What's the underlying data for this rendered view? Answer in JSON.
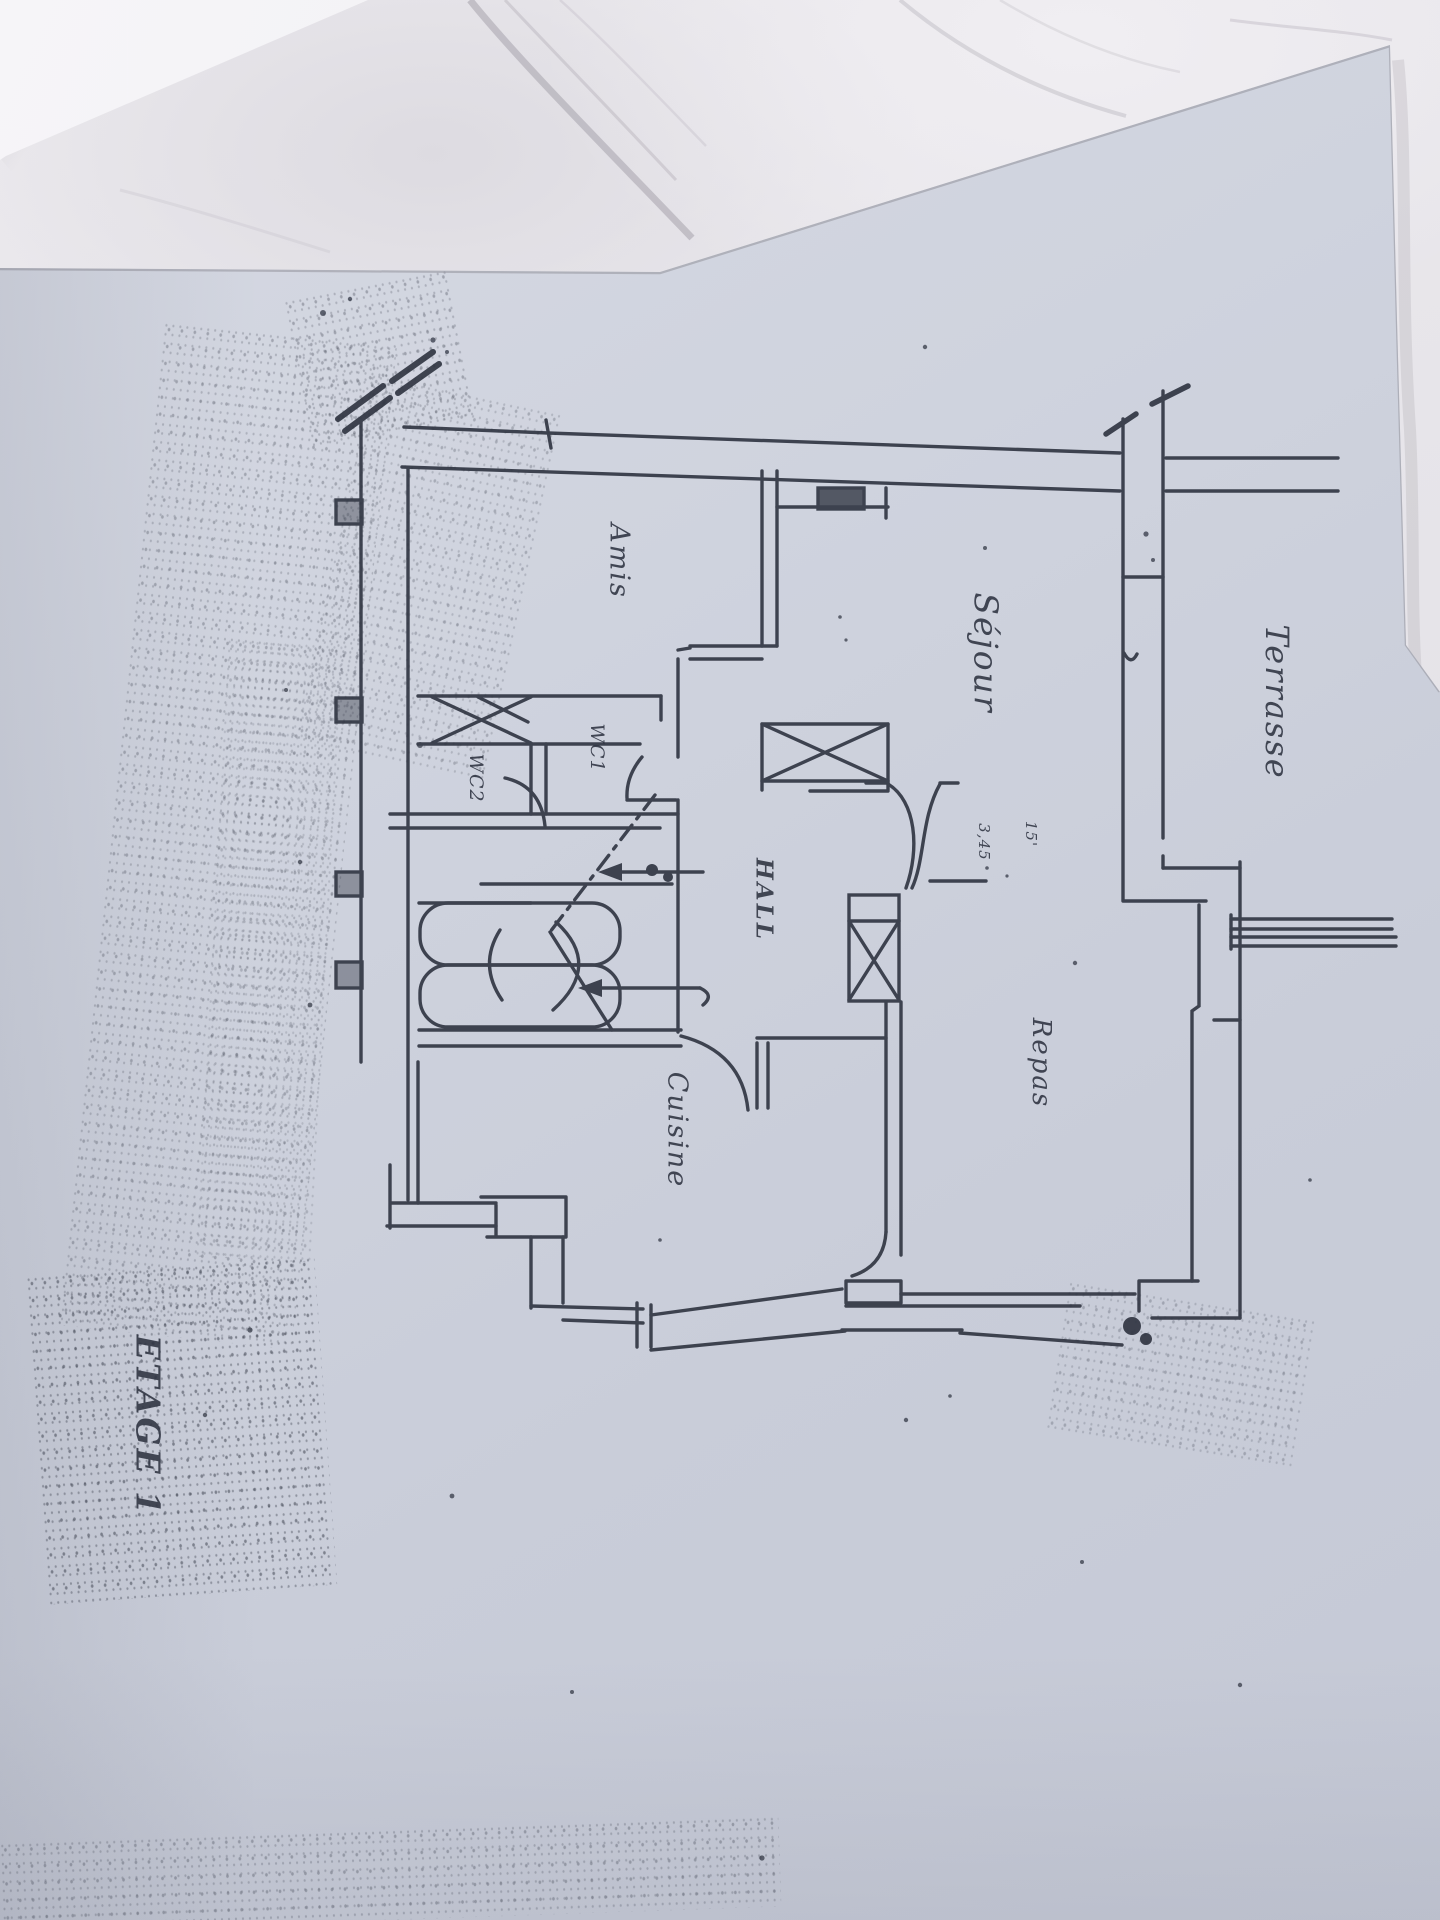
{
  "scene": {
    "description": "Photograph of a photocopied hand-drawn first-floor plan lying on a marble countertop; drawing and text are rotated 90 degrees clockwise; a corner of a white sheet overlaps at top-left",
    "surface": "marble countertop",
    "colors": {
      "marble": "#e9e7eb",
      "marble_vein": "#a9a6ae",
      "plan_paper": "#cdd1db",
      "loose_sheet": "#f3f2f5",
      "ink": "#2e3340"
    }
  },
  "plan": {
    "title": "ETAGE 1",
    "language": "French",
    "text_rotation_deg": 90,
    "rooms": {
      "terrasse": {
        "label": "Terrasse"
      },
      "sejour": {
        "label": "Séjour"
      },
      "amis": {
        "label": "Amis"
      },
      "hall": {
        "label": "HALL"
      },
      "wc1": {
        "label": "WC1"
      },
      "wc2": {
        "label": "WC2"
      },
      "cuisine": {
        "label": "Cuisine"
      },
      "repas": {
        "label": "Repas"
      }
    },
    "annotations": {
      "dim_a": {
        "text": "15'"
      },
      "dim_b": {
        "text": "3,45"
      }
    },
    "features": [
      "u-shaped staircase with dash-dot axis and direction arrows",
      "double swing door between hall and living/dining area",
      "x-hatched glazed partition between séjour and hall",
      "x-hatched duct column",
      "scribbled radiator block in séjour",
      "terrace access steps (double lines) at right",
      "wall break slashes at top corners",
      "hatched wall segment at WC"
    ]
  }
}
